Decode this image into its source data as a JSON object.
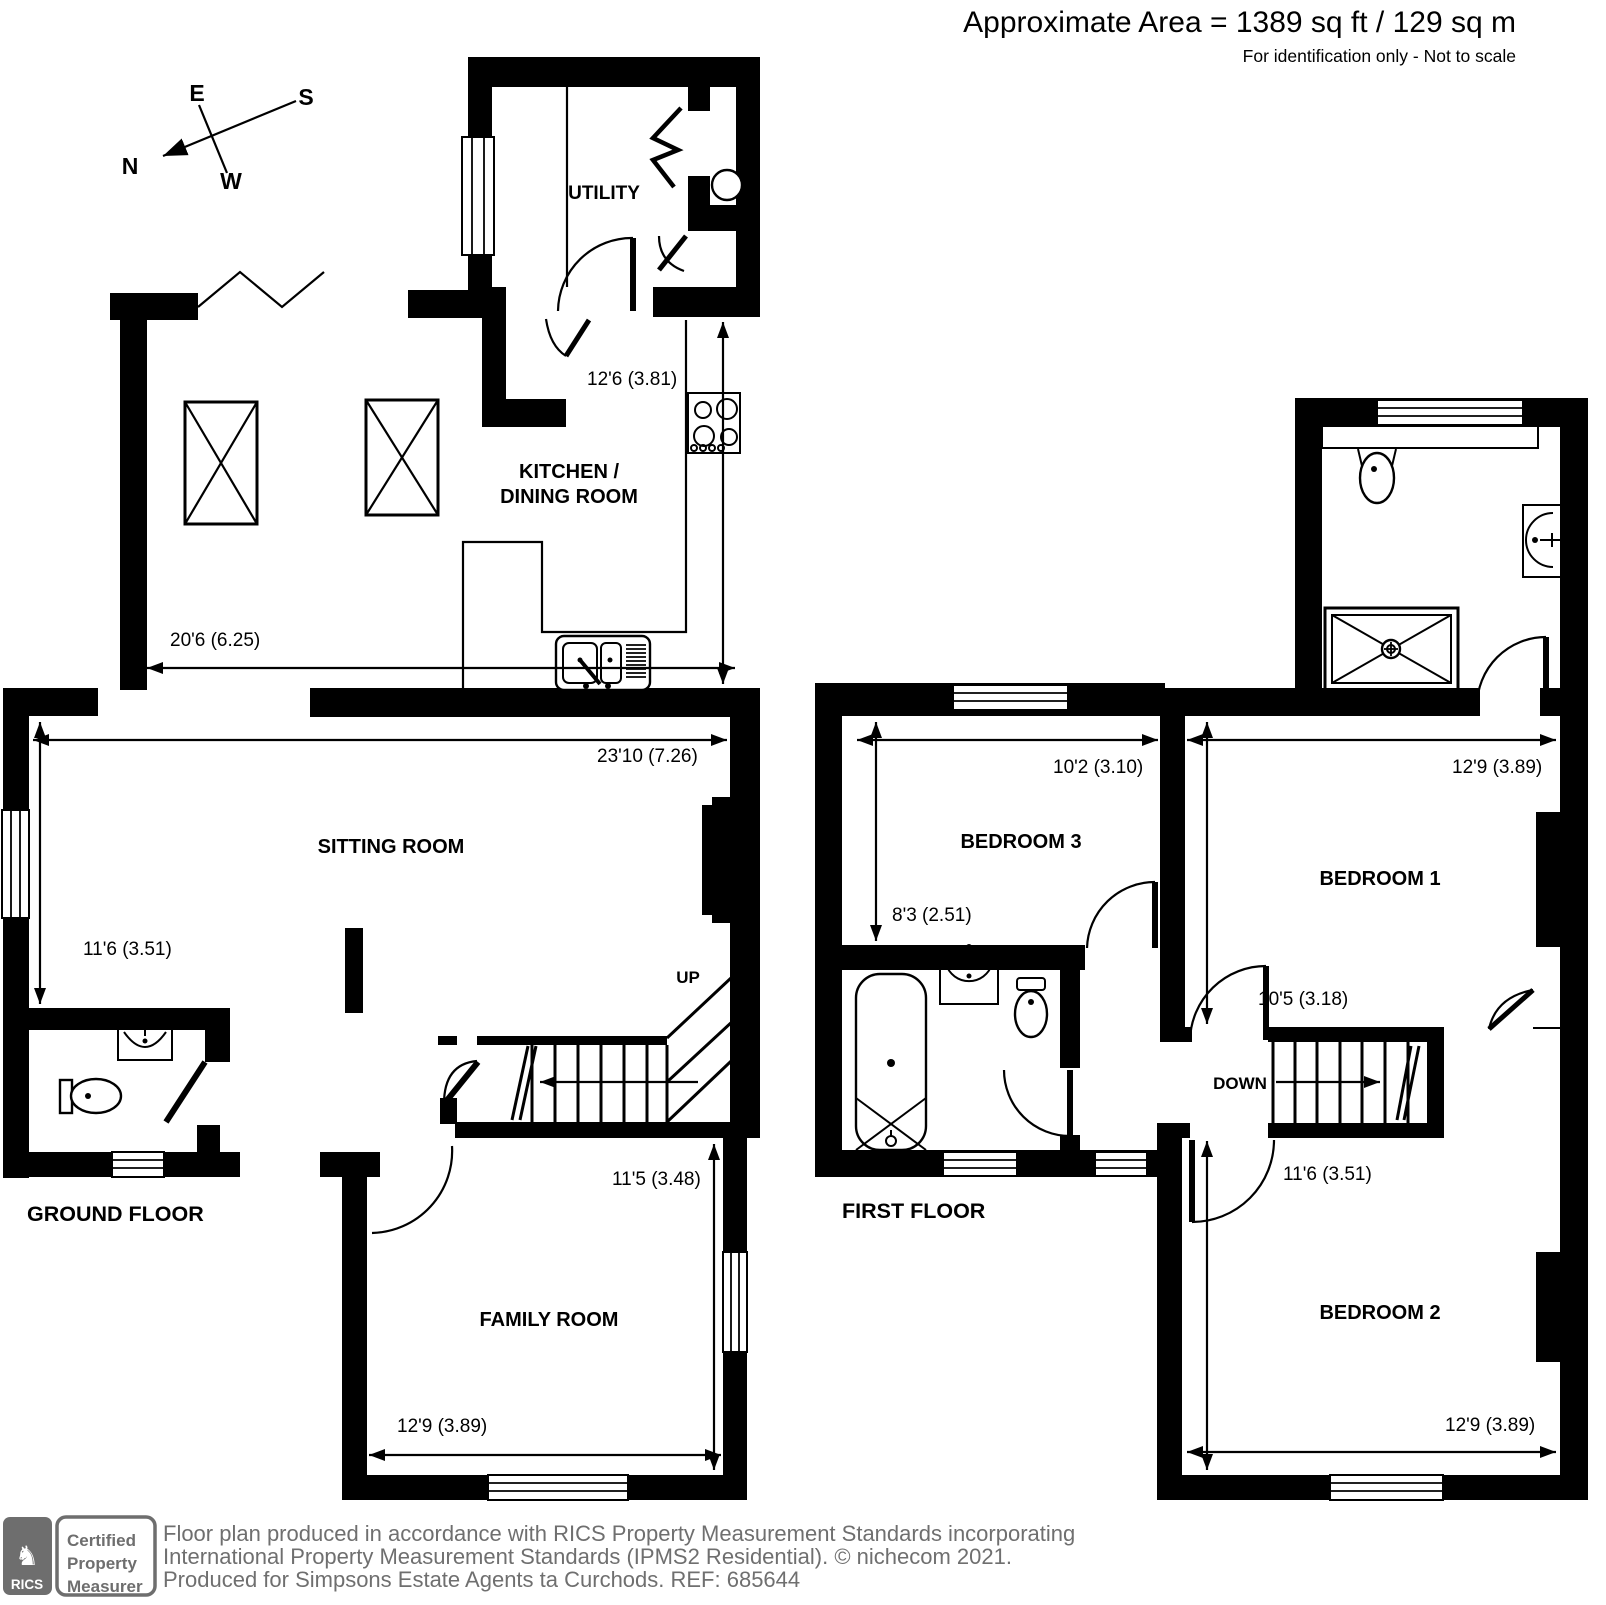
{
  "colors": {
    "ink": "#000000",
    "logo_gray": "#6e6e6e",
    "footer_gray": "#6f6f6f"
  },
  "header": {
    "area": "Approximate Area = 1389 sq ft / 129 sq m",
    "disclaimer": "For identification only - Not to scale"
  },
  "compass": {
    "n": "N",
    "e": "E",
    "s": "S",
    "w": "W"
  },
  "ground_floor": {
    "title": "GROUND FLOOR",
    "rooms": {
      "utility": "UTILITY",
      "kitchen_line1": "KITCHEN /",
      "kitchen_line2": "DINING ROOM",
      "sitting": "SITTING ROOM",
      "family": "FAMILY ROOM"
    },
    "stairs": "UP",
    "dims": {
      "kitchen_w": "20'6 (6.25)",
      "kitchen_h": "12'6 (3.81)",
      "sitting_w": "23'10 (7.26)",
      "sitting_h": "11'6 (3.51)",
      "family_h": "11'5 (3.48)",
      "family_w": "12'9 (3.89)"
    }
  },
  "first_floor": {
    "title": "FIRST FLOOR",
    "rooms": {
      "bedroom1": "BEDROOM 1",
      "bedroom2": "BEDROOM 2",
      "bedroom3": "BEDROOM 3"
    },
    "stairs": "DOWN",
    "dims": {
      "bed3_w": "10'2 (3.10)",
      "bed3_h": "8'3 (2.51)",
      "bed1_w": "12'9 (3.89)",
      "bed1_h": "10'5 (3.18)",
      "bed2_h": "11'6 (3.51)",
      "bed2_w": "12'9 (3.89)"
    }
  },
  "footer": {
    "line1": "Floor plan produced in accordance with RICS Property Measurement Standards incorporating",
    "line2": "International Property Measurement Standards (IPMS2 Residential).   © nichecom 2021.",
    "line3": "Produced for Simpsons Estate Agents ta Curchods.   REF:  685644",
    "logo_text": "RICS",
    "badge_line1": "Certified",
    "badge_line2": "Property",
    "badge_line3": "Measurer"
  }
}
